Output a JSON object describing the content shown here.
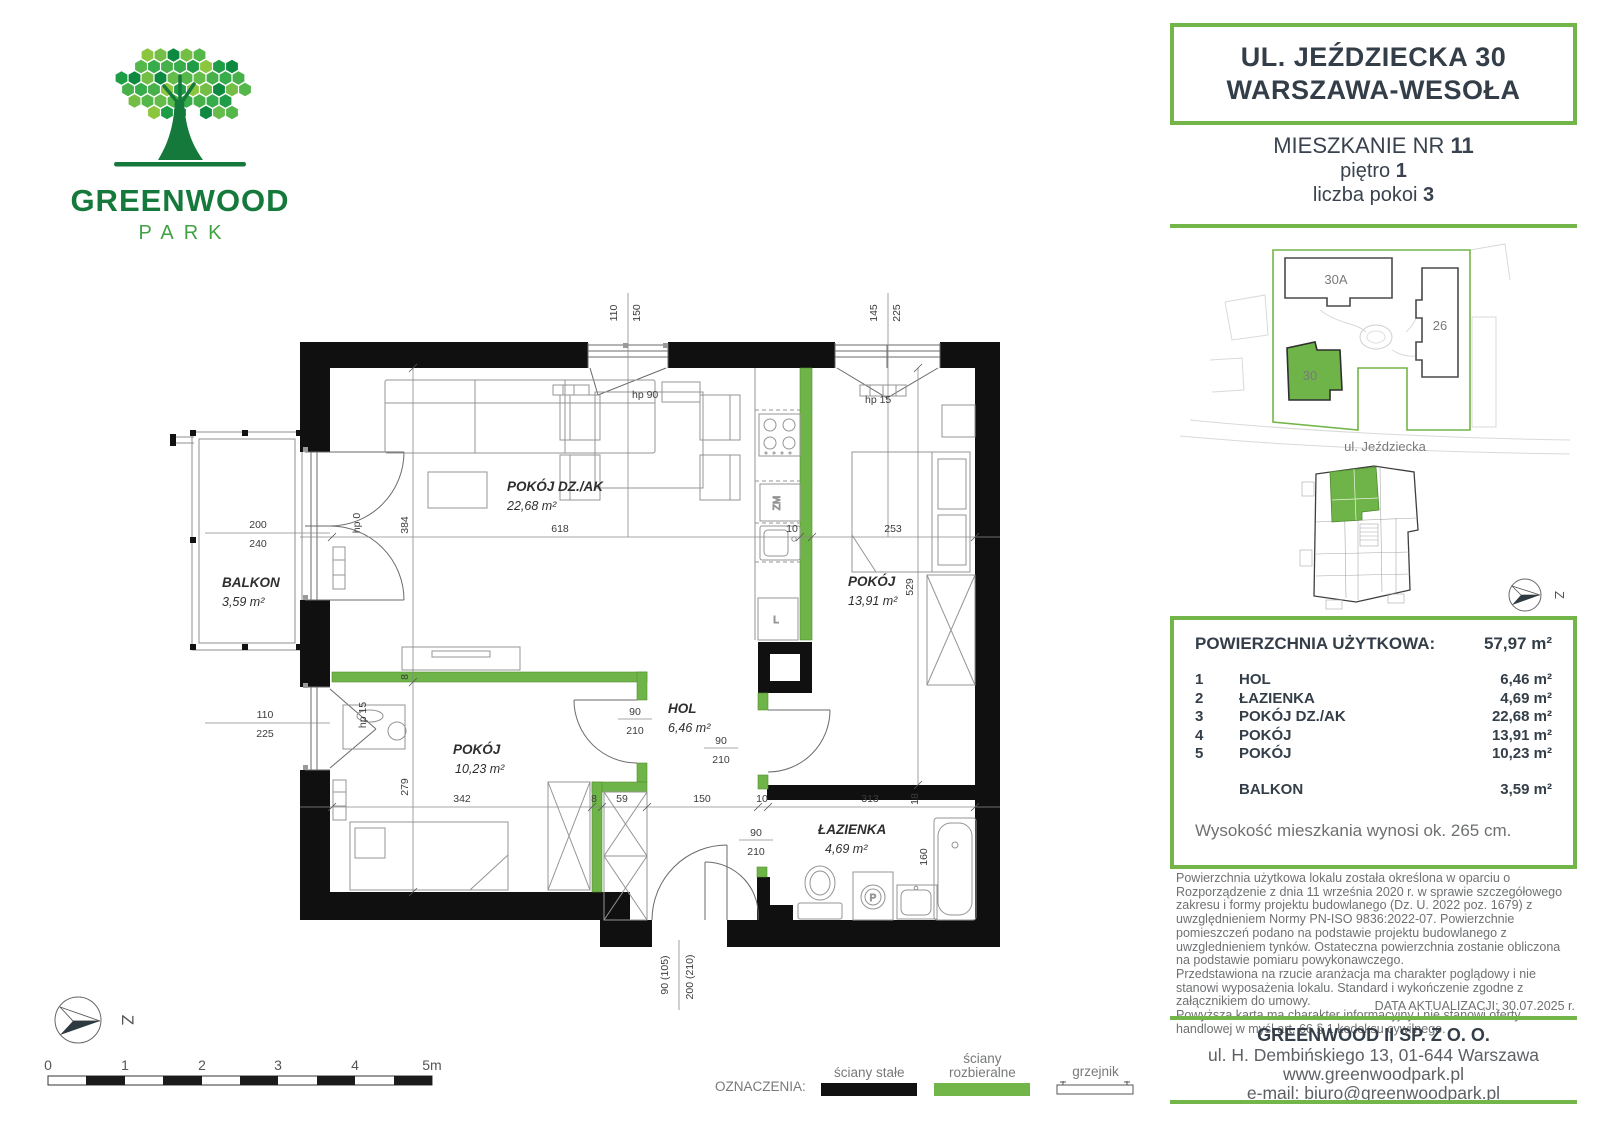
{
  "brand": {
    "name": "GREENWOOD",
    "sub": "PARK"
  },
  "header": {
    "line1": "UL. JEŹDZIECKA 30",
    "line2": "WARSZAWA-WESOŁA",
    "unit_label": "MIESZKANIE NR",
    "unit_value": "11",
    "floor_label": "piętro",
    "floor_value": "1",
    "rooms_label": "liczba pokoi",
    "rooms_value": "3"
  },
  "site_plan": {
    "buildings": {
      "a": "30A",
      "b": "26",
      "c": "30"
    },
    "street": "ul. Jeździecka"
  },
  "compass": {
    "label": "Z"
  },
  "floor_plan": {
    "rooms": {
      "living": {
        "name": "POKÓJ DZ./AK",
        "area": "22,68 m²"
      },
      "bedroom": {
        "name": "POKÓJ",
        "area": "13,91 m²"
      },
      "small_room": {
        "name": "POKÓJ",
        "area": "10,23 m²"
      },
      "hall": {
        "name": "HOL",
        "area": "6,46 m²"
      },
      "bathroom": {
        "name": "ŁAZIENKA",
        "area": "4,69 m²"
      },
      "balcony": {
        "name": "BALKON",
        "area": "3,59 m²"
      }
    },
    "dims": {
      "win_living_a": "110",
      "win_living_b": "150",
      "win_bedroom_a": "145",
      "win_bedroom_b": "225",
      "balcony_door_a": "200",
      "balcony_door_b": "240",
      "win_small_a": "110",
      "win_small_b": "225",
      "hp_living": "hp 90",
      "hp_bedroom": "hp 15",
      "hp_small": "hp 15",
      "hp_balcony": "hp 0",
      "living_w": "618",
      "living_h": "384",
      "bed_w": "253",
      "bedroom_h": "529",
      "small_h": "279",
      "small_w": "342",
      "g1": "8",
      "g2": "8",
      "seg59": "59",
      "seg150": "150",
      "seg10a": "10",
      "seg10b": "10",
      "seg313": "313",
      "seg18": "18",
      "tub": "160",
      "door1_w": "90",
      "door1_h": "210",
      "door2_w": "90",
      "door2_h": "210",
      "door3_w": "90",
      "door3_h": "210",
      "entry_w": "90 (105)",
      "entry_h": "200 (210)"
    },
    "fixtures": {
      "dishwasher": "ZM",
      "fridge": "L",
      "washer": "P"
    }
  },
  "area_table": {
    "title": "POWIERZCHNIA UŻYTKOWA:",
    "total": "57,97 m²",
    "rows": [
      {
        "no": "1",
        "name": "HOL",
        "area": "6,46 m²"
      },
      {
        "no": "2",
        "name": "ŁAZIENKA",
        "area": "4,69 m²"
      },
      {
        "no": "3",
        "name": "POKÓJ DZ./AK",
        "area": "22,68 m²"
      },
      {
        "no": "4",
        "name": "POKÓJ",
        "area": "13,91 m²"
      },
      {
        "no": "5",
        "name": "POKÓJ",
        "area": "10,23 m²"
      }
    ],
    "balcony": {
      "name": "BALKON",
      "area": "3,59 m²"
    },
    "height_note": "Wysokość mieszkania wynosi ok. 265 cm."
  },
  "disclaimer": {
    "paragraphs": [
      "Powierzchnia użytkowa lokalu została określona w oparciu o Rozporządzenie z dnia 11 września 2020 r. w sprawie szczegółowego zakresu i formy projektu budowlanego (Dz. U. 2022 poz. 1679) z uwzględnieniem Normy PN-ISO 9836:2022-07. Powierzchnie pomieszczeń podano na podstawie projektu budowlanego z uwzglednieniem tynków. Ostateczna powierzchnia zostanie obliczona na podst­awie pomiaru powykonawczego.",
      "Przedstawiona na rzucie aranżacja ma charakter poglądowy i nie stanowi wyposażenia lokalu. Standard i wykończenie zgodne z załącznikiem do umowy.",
      "Powyższa karta ma charakter informacyjny i nie stanowi oferty handlowej w myśl art. 66 § 1 kodeksu cywilnego."
    ],
    "updated": "DATA AKTUALIZACJI: 30.07.2025 r."
  },
  "footer": {
    "company": "GREENWOOD II SP. Z O. O.",
    "address": "ul. H. Dembińskiego 13, 01-644 Warszawa",
    "website": "www.greenwoodpark.pl",
    "email": "e-mail: biuro@greenwoodpark.pl"
  },
  "legend": {
    "title": "OZNACZENIA:",
    "solid": "ściany stałe",
    "demountable": "ściany rozbieralne",
    "radiator": "grzejnik"
  },
  "scale_bar": {
    "ticks": [
      "0",
      "1",
      "2",
      "3",
      "4"
    ],
    "end": "5m"
  }
}
